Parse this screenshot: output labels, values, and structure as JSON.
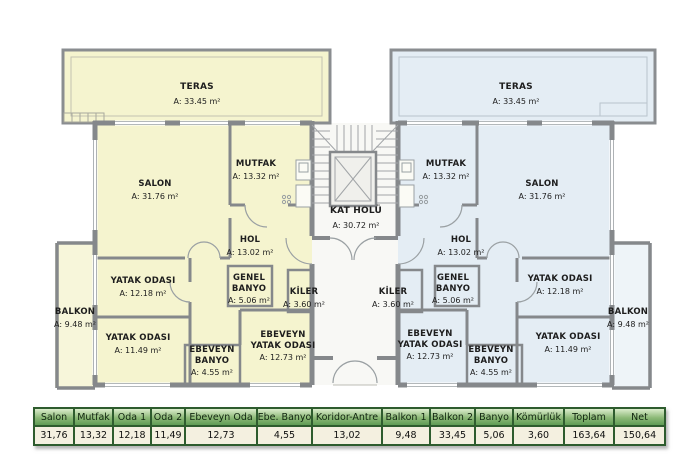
{
  "plan": {
    "core": {
      "kat_holu": {
        "name": "KAT HOLÜ",
        "area": "A: 30.72 m²"
      }
    },
    "left": {
      "fill": "#f5f4cf",
      "teras": {
        "name": "TERAS",
        "area": "A: 33.45 m²"
      },
      "salon": {
        "name": "SALON",
        "area": "A: 31.76 m²"
      },
      "mutfak": {
        "name": "MUTFAK",
        "area": "A: 13.32 m²"
      },
      "hol": {
        "name": "HOL",
        "area": "A: 13.02 m²"
      },
      "yatak1": {
        "name": "YATAK ODASI",
        "area": "A: 12.18 m²"
      },
      "genel_banyo": {
        "name": "GENEL\nBANYO",
        "area": "A: 5.06 m²"
      },
      "kiler": {
        "name": "KİLER",
        "area": "A: 3.60 m²"
      },
      "balkon": {
        "name": "BALKON",
        "area": "A: 9.48 m²"
      },
      "yatak2": {
        "name": "YATAK ODASI",
        "area": "A: 11.49 m²"
      },
      "ebeveyn_banyo": {
        "name": "EBEVEYN\nBANYO",
        "area": "A: 4.55 m²"
      },
      "ebeveyn_yatak": {
        "name": "EBEVEYN\nYATAK ODASI",
        "area": "A: 12.73 m²"
      }
    },
    "right": {
      "fill": "#e4edf4",
      "teras": {
        "name": "TERAS",
        "area": "A: 33.45 m²"
      },
      "salon": {
        "name": "SALON",
        "area": "A: 31.76 m²"
      },
      "mutfak": {
        "name": "MUTFAK",
        "area": "A: 13.32 m²"
      },
      "hol": {
        "name": "HOL",
        "area": "A: 13.02 m²"
      },
      "yatak1": {
        "name": "YATAK ODASI",
        "area": "A: 12.18 m²"
      },
      "genel_banyo": {
        "name": "GENEL\nBANYO",
        "area": "A: 5.06 m²"
      },
      "kiler": {
        "name": "KİLER",
        "area": "A: 3.60 m²"
      },
      "balkon": {
        "name": "BALKON",
        "area": "A: 9.48 m²"
      },
      "yatak2": {
        "name": "YATAK ODASI",
        "area": "A: 11.49 m²"
      },
      "ebeveyn_banyo": {
        "name": "EBEVEYN\nBANYO",
        "area": "A: 4.55 m²"
      },
      "ebeveyn_yatak": {
        "name": "EBEVEYN\nYATAK ODASI",
        "area": "A: 12.73 m²"
      }
    },
    "colors": {
      "left_unit_fill": "#f5f4cf",
      "right_unit_fill": "#e4edf4",
      "wall_gray": "#85888b",
      "table_border_green": "#2e5c2e",
      "table_header_green": "#5f9c55",
      "table_value_bg": "#f4f0e0"
    }
  },
  "table": {
    "columns": [
      {
        "label": "Salon",
        "value": "31,76"
      },
      {
        "label": "Mutfak",
        "value": "13,32"
      },
      {
        "label": "Oda 1",
        "value": "12,18"
      },
      {
        "label": "Oda 2",
        "value": "11,49"
      },
      {
        "label": "Ebeveyn Oda",
        "value": "12,73"
      },
      {
        "label": "Ebe. Banyo",
        "value": "4,55"
      },
      {
        "label": "Koridor-Antre",
        "value": "13,02"
      },
      {
        "label": "Balkon 1",
        "value": "9,48"
      },
      {
        "label": "Balkon 2",
        "value": "33,45"
      },
      {
        "label": "Banyo",
        "value": "5,06"
      },
      {
        "label": "Kömürlük",
        "value": "3,60"
      },
      {
        "label": "Toplam",
        "value": "163,64"
      },
      {
        "label": "Net",
        "value": "150,64"
      }
    ]
  }
}
